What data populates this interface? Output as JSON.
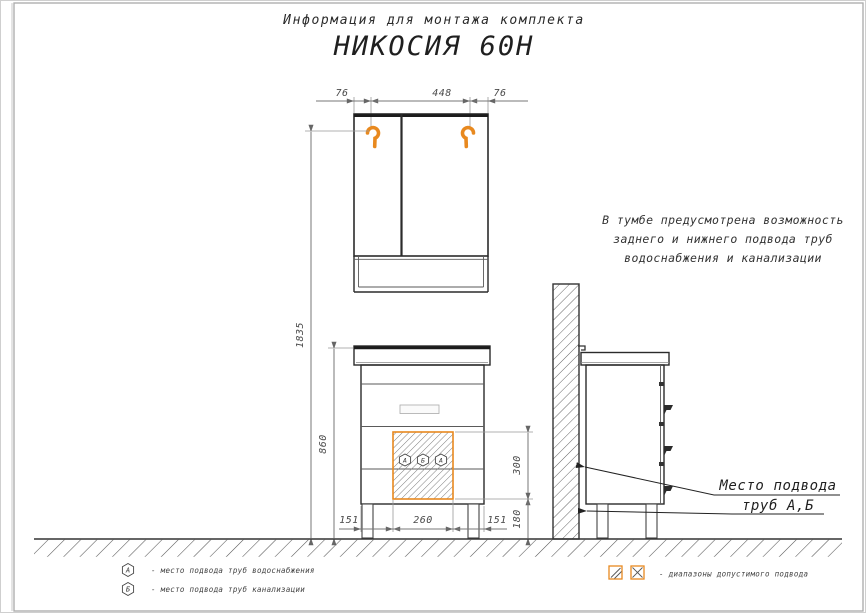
{
  "title": {
    "subtitle": "Информация для монтажа комплекта",
    "main": "НИКОСИЯ 60Н"
  },
  "dims": {
    "top_left": "76",
    "top_center": "448",
    "top_right": "76",
    "total_height": "1835",
    "cabinet_height": "860",
    "zone_height": "300",
    "zone_floor": "180",
    "bottom_left": "151",
    "bottom_center": "260",
    "bottom_right": "151"
  },
  "note": {
    "line1": "В тумбе предусмотрена возможность",
    "line2": "заднего и нижнего подвода труб",
    "line3": "водоснабжения и канализации"
  },
  "callout": {
    "line1": "Место подвода",
    "line2": "труб А,Б"
  },
  "zone_markers": [
    "А",
    "Б",
    "А"
  ],
  "legend": {
    "water_symbol": "А",
    "water_text": "- место подвода труб водоснабжения",
    "sewer_symbol": "Б",
    "sewer_text": "- место подвода труб канализации",
    "zones_text": "- диапазоны допустимого подвода"
  },
  "colors": {
    "accent": "#E8891F",
    "line": "#2B2B2B",
    "dim": "#777777"
  }
}
